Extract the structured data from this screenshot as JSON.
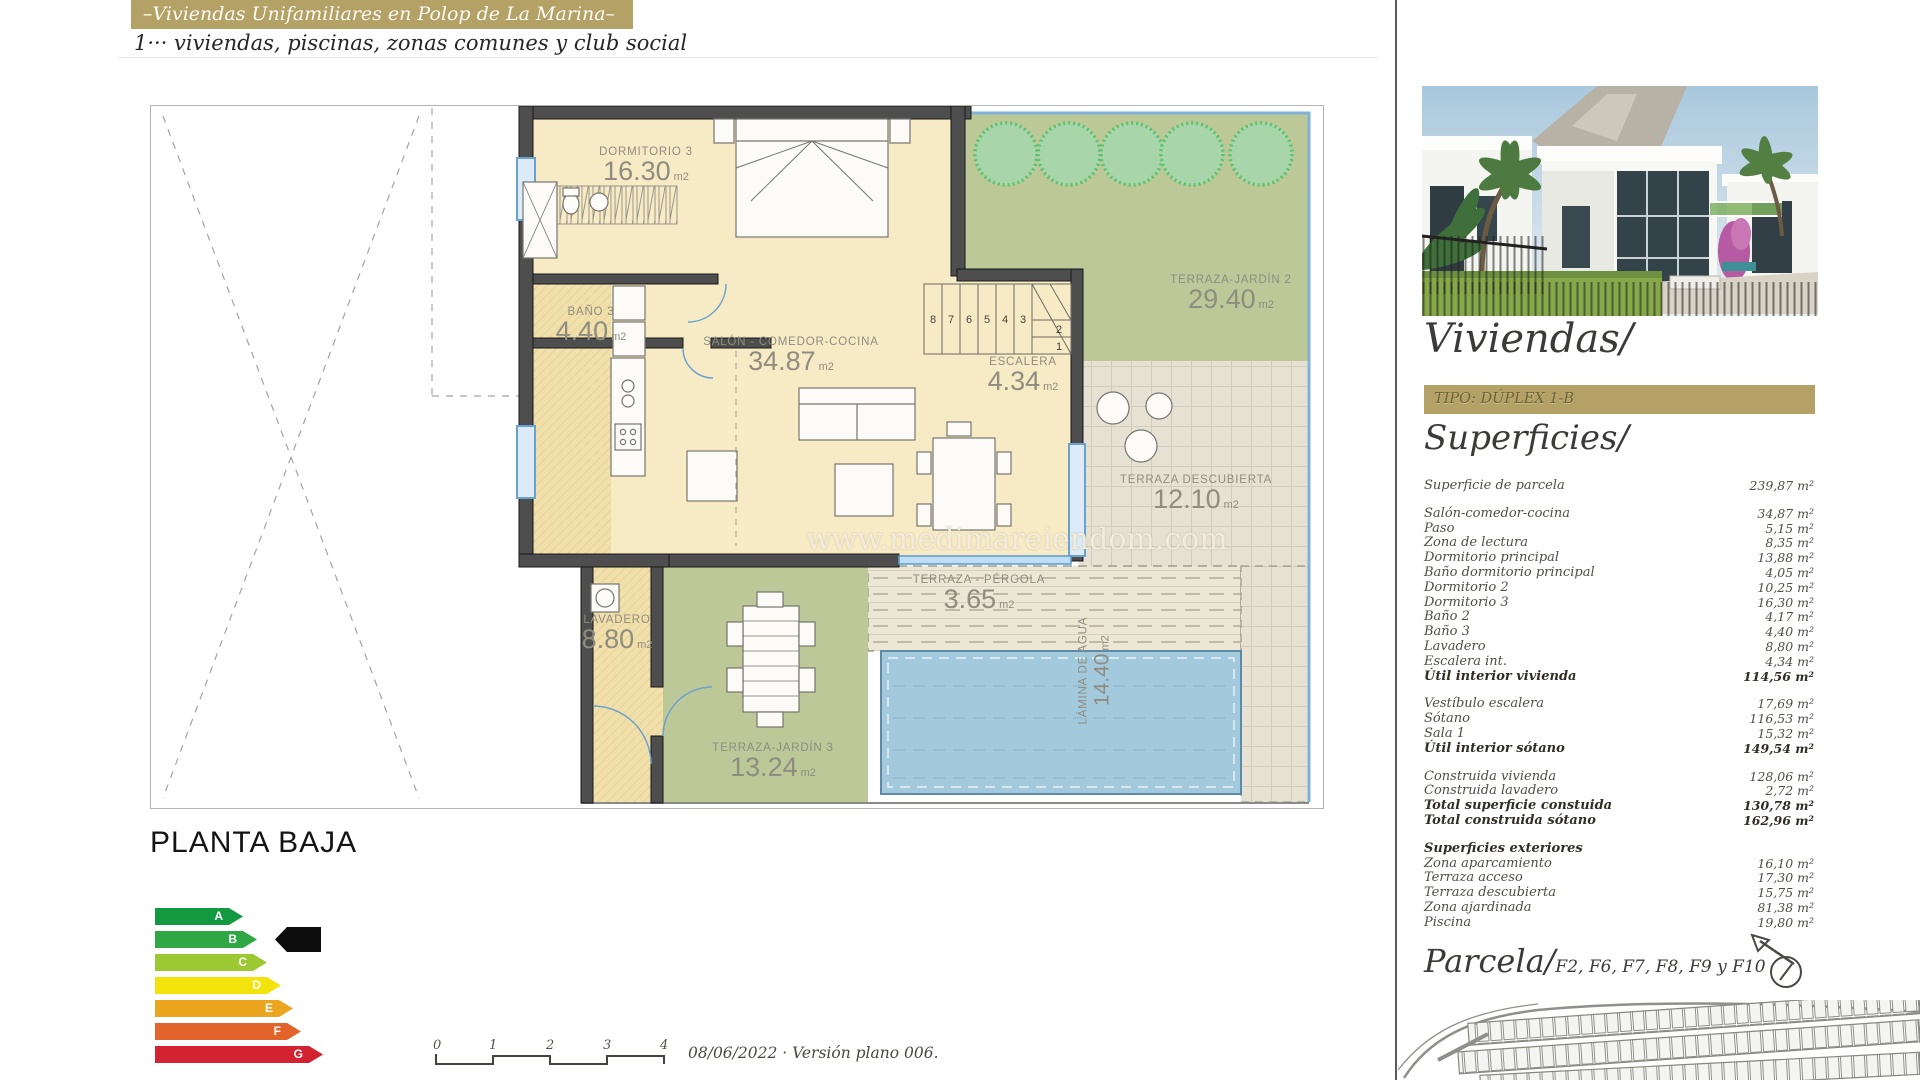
{
  "header": {
    "banner": "–Viviendas Unifamiliares en Polop de La Marina–",
    "subtitle": "1··· viviendas, piscinas, zonas comunes y club social"
  },
  "plan": {
    "title": "PLANTA BAJA",
    "watermark": "www.medimareiendom.com",
    "rooms": {
      "dormitorio3": {
        "name": "DORMITORIO 3",
        "area": "16.30",
        "unit": "m2"
      },
      "bano3": {
        "name": "BAÑO 3",
        "area": "4.40",
        "unit": "m2"
      },
      "salon": {
        "name": "SALÓN - COMEDOR-COCINA",
        "area": "34.87",
        "unit": "m2"
      },
      "escalera": {
        "name": "ESCALERA",
        "area": "4.34",
        "unit": "m2"
      },
      "jardin2": {
        "name": "TERRAZA-JARDÍN 2",
        "area": "29.40",
        "unit": "m2"
      },
      "descubierta": {
        "name": "TERRAZA DESCUBIERTA",
        "area": "12.10",
        "unit": "m2"
      },
      "pergola": {
        "name": "TERRAZA - PÉRGOLA",
        "area": "3.65",
        "unit": "m2"
      },
      "lavadero": {
        "name": "LAVADERO",
        "area": "8.80",
        "unit": "m2"
      },
      "jardin3": {
        "name": "TERRAZA-JARDÍN 3",
        "area": "13.24",
        "unit": "m2"
      },
      "lamina": {
        "name": "LÁMINA DE AGUA",
        "area": "14.40",
        "unit": "m2"
      }
    },
    "stairs": [
      "8",
      "7",
      "6",
      "5",
      "4",
      "3",
      "2",
      "1"
    ],
    "scale_ticks": [
      "0",
      "1",
      "2",
      "3",
      "4"
    ],
    "version_note": "08/06/2022 · Versión plano 006."
  },
  "energy": {
    "rating": "B",
    "grades": [
      {
        "letter": "A",
        "color": "#13993f",
        "width": "88px"
      },
      {
        "letter": "B",
        "color": "#2fa844",
        "width": "102px"
      },
      {
        "letter": "C",
        "color": "#9cc831",
        "width": "112px"
      },
      {
        "letter": "D",
        "color": "#f2e30c",
        "width": "126px"
      },
      {
        "letter": "E",
        "color": "#eca51f",
        "width": "138px"
      },
      {
        "letter": "F",
        "color": "#e2642b",
        "width": "146px"
      },
      {
        "letter": "G",
        "color": "#d32232",
        "width": "168px"
      }
    ]
  },
  "sidebar": {
    "title": "Viviendas/",
    "type_banner": "TIPO: DÚPLEX 1-B",
    "surfaces_title": "Superficies/",
    "rows": [
      {
        "label": "Superficie de parcela",
        "value": "239,87 m²"
      },
      {
        "label": "",
        "value": "",
        "cls": "gap"
      },
      {
        "label": "Salón-comedor-cocina",
        "value": "34,87 m²"
      },
      {
        "label": "Paso",
        "value": "5,15 m²"
      },
      {
        "label": "Zona de lectura",
        "value": "8,35 m²"
      },
      {
        "label": "Dormitorio principal",
        "value": "13,88 m²"
      },
      {
        "label": "Baño dormitorio principal",
        "value": "4,05 m²"
      },
      {
        "label": "Dormitorio 2",
        "value": "10,25 m²"
      },
      {
        "label": "Dormitorio 3",
        "value": "16,30 m²"
      },
      {
        "label": "Baño 2",
        "value": "4,17 m²"
      },
      {
        "label": "Baño 3",
        "value": "4,40 m²"
      },
      {
        "label": "Lavadero",
        "value": "8,80 m²"
      },
      {
        "label": "Escalera int.",
        "value": "4,34 m²"
      },
      {
        "label": "Útil interior vivienda",
        "value": "114,56 m²",
        "cls": "bold"
      },
      {
        "label": "",
        "value": "",
        "cls": "gap"
      },
      {
        "label": "Vestíbulo escalera",
        "value": "17,69 m²"
      },
      {
        "label": "Sótano",
        "value": "116,53 m²"
      },
      {
        "label": "Sala 1",
        "value": "15,32 m²"
      },
      {
        "label": "Útil interior sótano",
        "value": "149,54 m²",
        "cls": "bold"
      },
      {
        "label": "",
        "value": "",
        "cls": "gap"
      },
      {
        "label": "Construida vivienda",
        "value": "128,06 m²"
      },
      {
        "label": "Construida lavadero",
        "value": "2,72 m²"
      },
      {
        "label": "Total superficie constuida",
        "value": "130,78 m²",
        "cls": "bold"
      },
      {
        "label": "Total construida sótano",
        "value": "162,96 m²",
        "cls": "bold"
      },
      {
        "label": "",
        "value": "",
        "cls": "gap"
      },
      {
        "label": "Superficies exteriores",
        "value": "",
        "cls": "bold"
      },
      {
        "label": "Zona aparcamiento",
        "value": "16,10 m²"
      },
      {
        "label": "Terraza acceso",
        "value": "17,30 m²"
      },
      {
        "label": "Terraza descubierta",
        "value": "15,75 m²"
      },
      {
        "label": "Zona ajardinada",
        "value": "81,38 m²"
      },
      {
        "label": "Piscina",
        "value": "19,80 m²"
      }
    ],
    "parcela_title": "Parcela/",
    "parcela_subtitle": "F2, F6, F7, F8, F9 y F10"
  },
  "colors": {
    "gold": "#b3a166",
    "floor": "#f7ebc6",
    "floor_dark": "#f2e0ab",
    "garden": "#bcc897",
    "pool": "#a3c9dd",
    "paving": "#e6e1d3",
    "wall": "#4e4e4e",
    "glass_blue": "#7fb2d8"
  }
}
